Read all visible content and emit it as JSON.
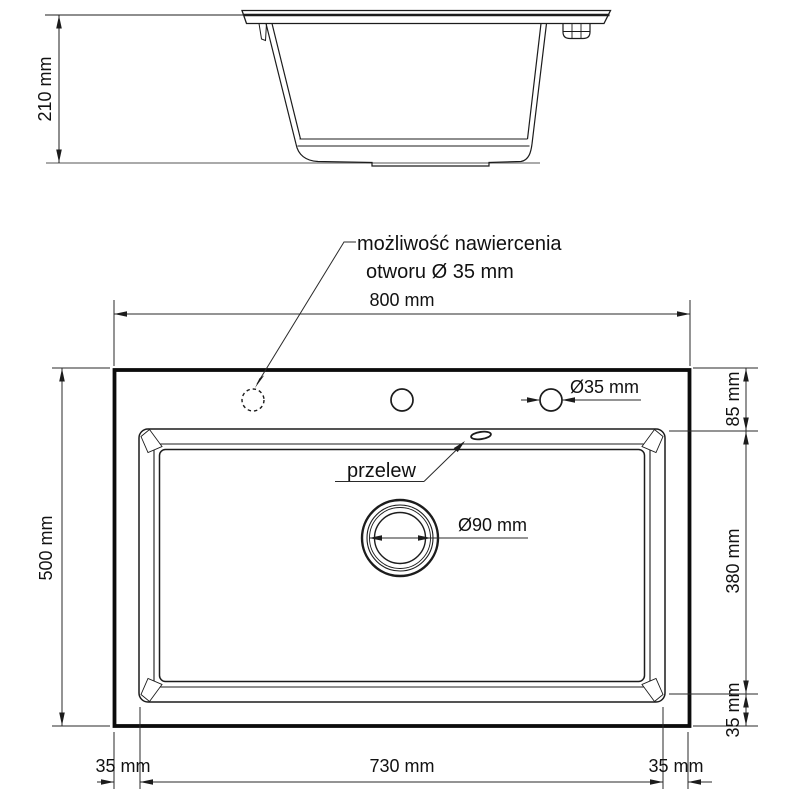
{
  "drawing_title": "sink-technical-drawing",
  "colors": {
    "line": "#1c1c1c",
    "thick_outline": "#0c0c0c",
    "ground_line": "#8d8d8d",
    "background": "#ffffff"
  },
  "side_view": {
    "height_label": "210 mm"
  },
  "top_view": {
    "width_label": "800 mm",
    "depth_label": "500 mm",
    "deck_offset_label": "85 mm",
    "bowl_length_label": "380 mm",
    "bowl_bottom_offset_label": "35 mm",
    "left_margin_label": "35 mm",
    "bowl_width_label": "730 mm",
    "right_margin_label": "35 mm",
    "faucet_hole_label": "Ø35 mm",
    "drain_label": "Ø90 mm",
    "overflow_label": "przelew",
    "drill_note_line1": "możliwość nawiercenia",
    "drill_note_line2": "otworu Ø 35 mm"
  }
}
